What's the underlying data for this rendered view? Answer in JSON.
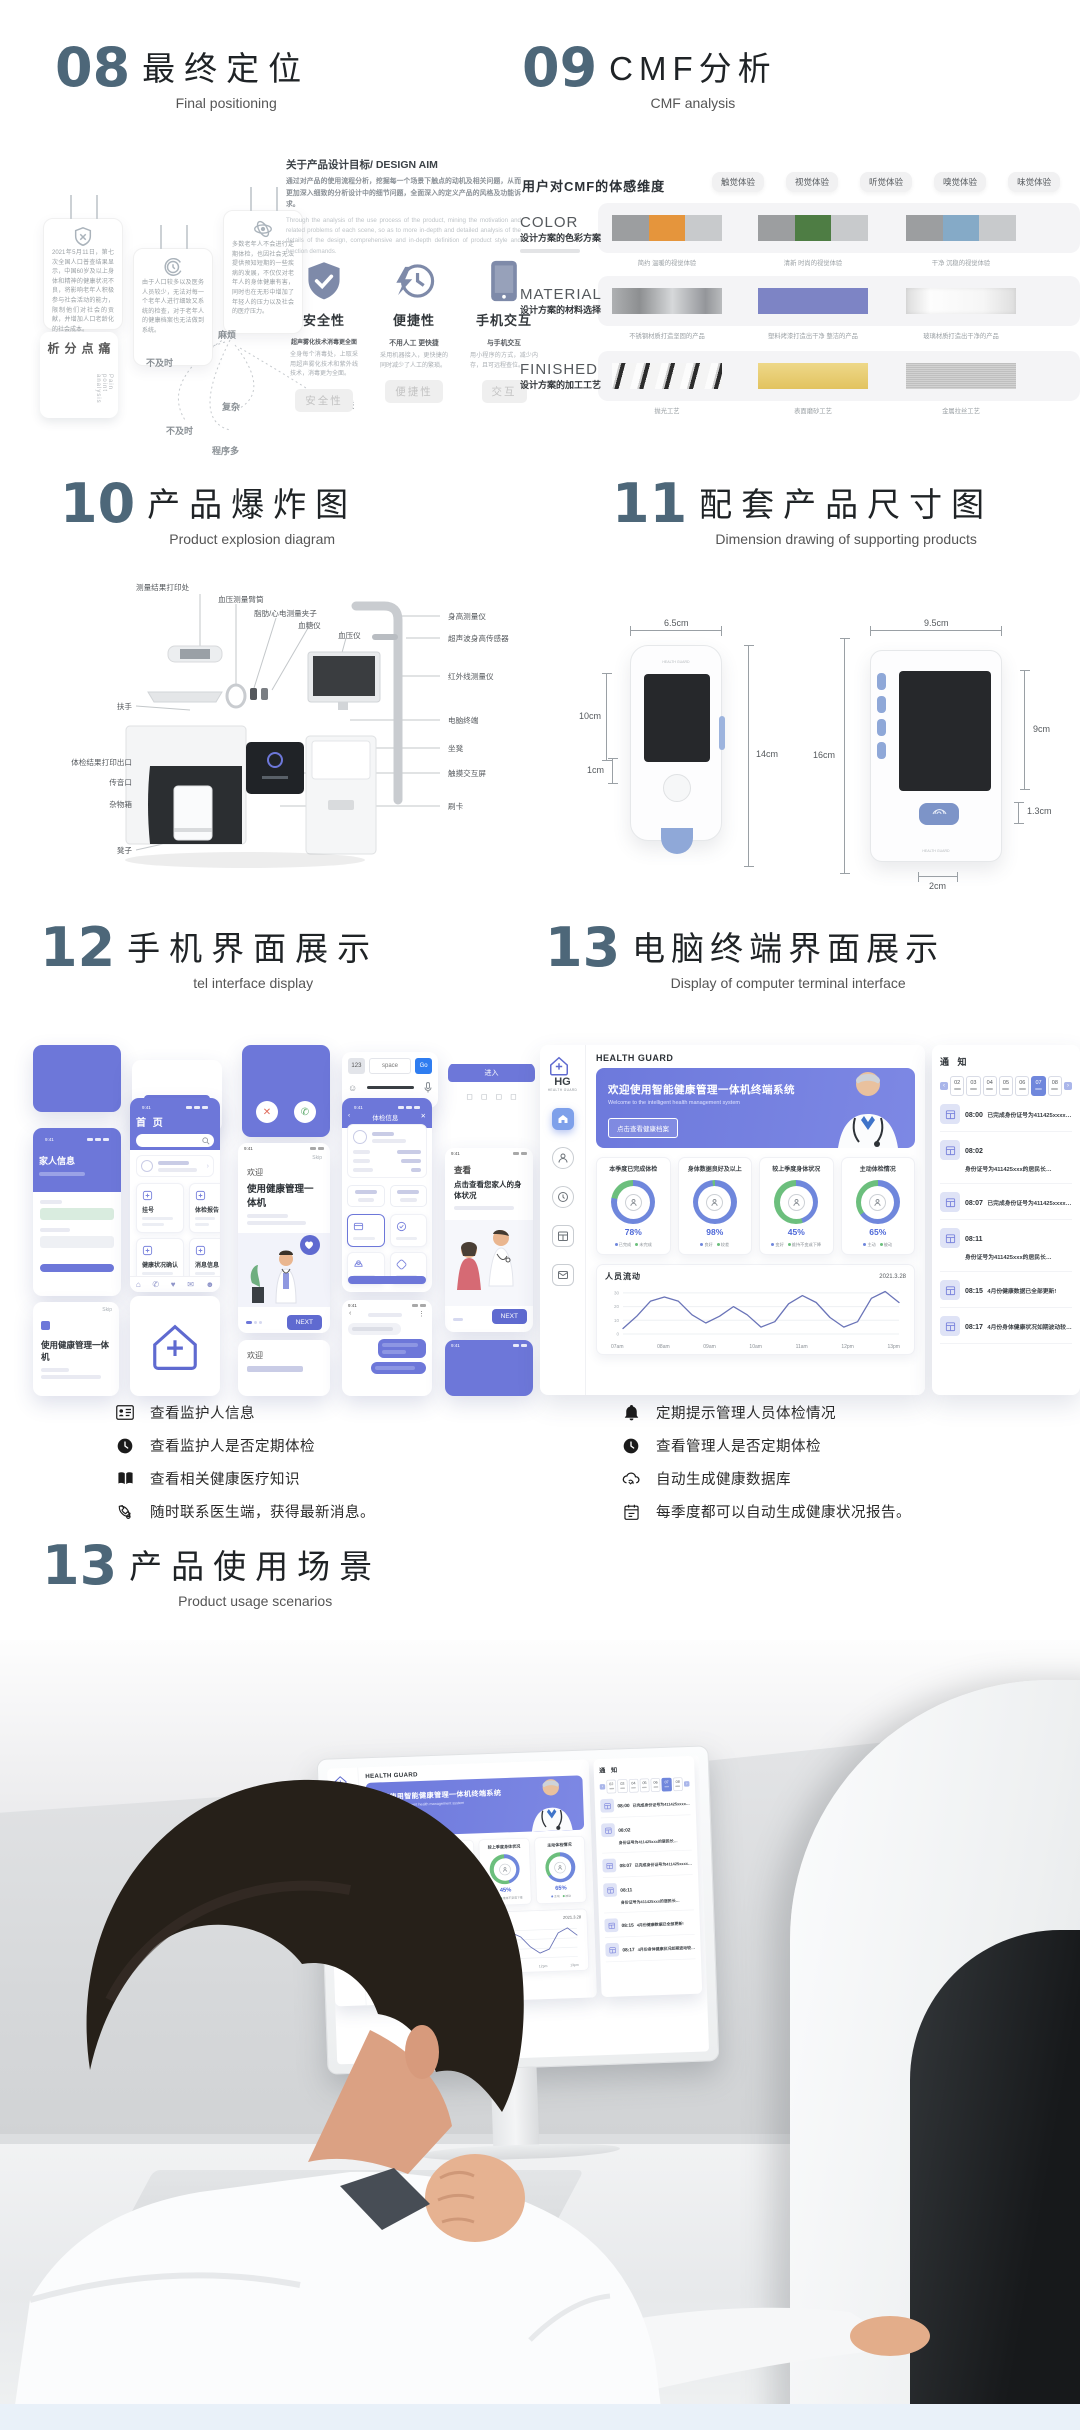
{
  "colors": {
    "accent_purple": "#6d77d9",
    "heading_slate": "#4d6779",
    "ring_blue": "#6f87dc",
    "ring_green": "#6cbf7d",
    "hero_purple": "#6d79dc"
  },
  "s08": {
    "num": "08",
    "title": "最终定位",
    "sub": "Final positioning",
    "cards": [
      {
        "text": "2021年5月11日，第七次全国人口普查结果显示，中国60岁及以上身体和精神的健康状况不良，将影响老年人积极参与社会活动的能力，限制他们对社会的贡献，并增加人口老龄化的社会成本。"
      },
      {
        "text": "由于人口较多以及医务人员较少，无法对每一个老年人进行细致又系统的检查，对于老年人的健康档案也无法做到系统。"
      },
      {
        "text": "多数老年人不会进行定期体检，也因社会无法提供预知短期的一些疾病的发展，不仅仅对老年人的身体健康有害，同时也在无形中增加了年轻人的压力以及社会的医疗压力。"
      }
    ],
    "pain": {
      "cn": "痛点分析",
      "en": "Pain point analysis"
    },
    "keywords": [
      "麻烦",
      "不及时",
      "复杂",
      "无法亲子互联",
      "不及时",
      "程序多"
    ],
    "aim_label": "关于产品设计目标/ DESIGN AIM",
    "aim_cn": "通过对产品的使用流程分析，挖掘每一个场景下触点的动机及相关问题，从而更加深入细致的分析设计中的细节问题，全面深入的定义产品的风格及功能诉求。",
    "aim_en": "Through the analysis of the use process of the product, mining the motivation and related problems of each scene, so as to more in-depth and detailed analysis of the details of the design, comprehensive and in-depth definition of product style and function demands.",
    "features": [
      {
        "title": "安全性",
        "strong": "超声雾化技术消毒更全面",
        "desc": "全身每个消毒处，上取采用超声雾化技术和紫外线技术，消毒更为全面。",
        "chip": "安全性"
      },
      {
        "title": "便捷性",
        "strong": "不用人工 更快捷",
        "desc": "采用机器接入，更快捷的同时减少了人工的繁琐。",
        "chip": "便捷性"
      },
      {
        "title": "手机交互",
        "strong": "与手机交互",
        "desc": "用小程序的方式，减少内存，且可远程查位。",
        "chip": "交互"
      }
    ]
  },
  "s09": {
    "num": "09",
    "title": "CMF分析",
    "sub": "CMF analysis",
    "dim_label": "用户对CMF的体感维度",
    "chips": [
      "触觉体验",
      "视觉体验",
      "听觉体验",
      "嗅觉体验",
      "味觉体验"
    ],
    "color_row": {
      "name": "COLOR",
      "sub": "设计方案的色彩方案",
      "items": [
        {
          "caption": "简约 温暖的视觉体验",
          "colors": [
            "#9c9ea0",
            "#e5953c",
            "#c8cacc"
          ]
        },
        {
          "caption": "清新 时尚的视觉体验",
          "colors": [
            "#9c9ea0",
            "#4e7d44",
            "#c8cacc"
          ]
        },
        {
          "caption": "干净 沉稳的视觉体验",
          "colors": [
            "#9c9ea0",
            "#85aac7",
            "#c8cacc"
          ]
        }
      ]
    },
    "material_row": {
      "name": "MATERIAL",
      "sub": "设计方案的材料选择",
      "items": [
        {
          "caption": "不锈钢材质打造坚固的产品",
          "texture": "steel"
        },
        {
          "caption": "塑料烤漆打造出干净 整洁的产品",
          "texture": "plastic"
        },
        {
          "caption": "玻璃材质打造出干净的产品",
          "texture": "glass"
        }
      ]
    },
    "finished_row": {
      "name": "FINISHED",
      "sub": "设计方案的加工工艺",
      "items": [
        {
          "caption": "抛光工艺",
          "texture": "polish"
        },
        {
          "caption": "表面磨砂工艺",
          "texture": "mattegold"
        },
        {
          "caption": "金属拉丝工艺",
          "texture": "brushed"
        }
      ]
    }
  },
  "s10": {
    "num": "10",
    "title": "产品爆炸图",
    "sub": "Product explosion diagram",
    "labels": {
      "print_spot": "测量结果打印处",
      "cuff": "血压测量臂筒",
      "clip": "脂肪/心电测量夹子",
      "glucose": "血糖仪",
      "bp": "血压仪",
      "armrest": "扶手",
      "result_outlet": "体检结果打印出口",
      "voice_port": "传音口",
      "storage": "杂物箱",
      "stool": "凳子",
      "height": "身高测量仪",
      "ultrasonic": "超声波身高传感器",
      "infrared": "红外线测量仪",
      "terminal": "电脑终端",
      "seat": "坐凳",
      "touch": "触摸交互屏",
      "card": "刷卡"
    }
  },
  "s11": {
    "num": "11",
    "title": "配套产品尺寸图",
    "sub": "Dimension drawing of supporting products",
    "dims": {
      "w1": "6.5cm",
      "h1s": "10cm",
      "h1": "14cm",
      "btn1": "1cm",
      "w2": "9.5cm",
      "h2": "16cm",
      "h2s": "9cm",
      "r13": "1.3cm",
      "r2": "2cm"
    }
  },
  "s12": {
    "num": "12",
    "title": "手机界面展示",
    "sub": "tel interface display",
    "time": "9:41",
    "home": {
      "title": "首 页",
      "menu": [
        {
          "t": "挂号"
        },
        {
          "t": "体检报告"
        },
        {
          "t": "健康状况确认"
        },
        {
          "t": "消息信息"
        },
        {
          "t": "健康档案"
        },
        {
          "t": "建议预警"
        }
      ]
    },
    "welcome": {
      "hello": "欢迎",
      "title": "使用健康管理一体机",
      "skip": "Skip",
      "next": "NEXT"
    },
    "view": {
      "hello": "查看",
      "title": "点击查看您家人的身体状况",
      "next": "NEXT"
    },
    "family": {
      "title": "家人信息"
    },
    "checkup": {
      "title": "体检信息"
    },
    "machine_card": "使用健康管理一体机",
    "welcome_small": "欢迎",
    "enter_btn": "进入",
    "keyboard": {
      "left": "123",
      "mid": "space",
      "go": "Go"
    }
  },
  "s13": {
    "num": "13",
    "title": "电脑终端界面展示",
    "sub": "Display of computer terminal interface",
    "terminal": {
      "brand": "HEALTH GUARD",
      "logo": {
        "hg": "HG",
        "sub": "HEALTH GUARD"
      },
      "hero": {
        "title": "欢迎使用智能健康管理一体机终端系统",
        "sub": "Welcome to the intelligent health management system",
        "btn": "点击查看健康档案"
      },
      "stats": [
        {
          "title": "本季度已完成体检",
          "pct": 78,
          "pct_label": "78%",
          "a": "已完成",
          "b": "未完成"
        },
        {
          "title": "身体数据良好及以上",
          "pct": 98,
          "pct_label": "98%",
          "a": "良好",
          "b": "较差"
        },
        {
          "title": "较上季度身体状况",
          "pct": 45,
          "pct_label": "45%",
          "a": "变好",
          "b": "维持不变或下降"
        },
        {
          "title": "主动体检情况",
          "pct": 65,
          "pct_label": "65%",
          "a": "主动",
          "b": "被动"
        }
      ],
      "flow": {
        "title": "人员流动",
        "date": "2021.3.28"
      },
      "notice": {
        "title": "通 知",
        "days": [
          {
            "d": "02"
          },
          {
            "d": "03"
          },
          {
            "d": "04"
          },
          {
            "d": "05"
          },
          {
            "d": "06"
          },
          {
            "d": "07",
            "cls": "sel"
          },
          {
            "d": "08"
          }
        ],
        "items": [
          {
            "time": "08:00",
            "text": "已完成身份证号为411425xxxx…"
          },
          {
            "time": "08:02",
            "text": "身份证号为411425xxx的居民长…"
          },
          {
            "time": "08:07",
            "text": "已完成身份证号为411425xxxx…"
          },
          {
            "time": "08:11",
            "text": "身份证号为411425xxx的居民长…"
          },
          {
            "time": "08:15",
            "text": "4月份健康数据已全部更新!"
          },
          {
            "time": "08:17",
            "text": "4月份身体健康状况如期波动较…"
          }
        ]
      }
    }
  },
  "legend": {
    "left": [
      {
        "icon": "id-card-icon",
        "text": "查看监护人信息"
      },
      {
        "icon": "clock-icon",
        "text": "查看监护人是否定期体检"
      },
      {
        "icon": "book-icon",
        "text": "查看相关健康医疗知识"
      },
      {
        "icon": "phone-call-icon",
        "text": "随时联系医生端，获得最新消息。"
      }
    ],
    "right": [
      {
        "icon": "bell-icon",
        "text": "定期提示管理人员体检情况"
      },
      {
        "icon": "clock-icon",
        "text": "查看管理人是否定期体检"
      },
      {
        "icon": "cloud-sync-icon",
        "text": "自动生成健康数据库"
      },
      {
        "icon": "calendar-icon",
        "text": "每季度都可以自动生成健康状况报告。"
      }
    ]
  },
  "s13b": {
    "num": "13",
    "title": "产品使用场景",
    "sub": "Product usage scenarios"
  },
  "chart_data": [
    {
      "type": "line",
      "title": "人员流动",
      "annotation_date": "2021.3.28",
      "x": [
        "07am",
        "08am",
        "09am",
        "10am",
        "11am",
        "12pm",
        "13pm"
      ],
      "values_at_ticks": [
        4,
        27,
        8,
        5,
        28,
        5,
        23
      ],
      "dense": [
        4,
        13,
        24,
        27,
        24,
        14,
        8,
        13,
        20,
        14,
        5,
        9,
        22,
        28,
        23,
        12,
        5,
        9,
        26,
        31,
        23
      ],
      "ylim": [
        0,
        35
      ],
      "yticks": [
        0,
        10,
        20,
        30
      ],
      "grid": true,
      "legend_position": "none",
      "ylabel": "",
      "xlabel": ""
    },
    {
      "type": "donut-set",
      "title": "体检数据占比",
      "items": [
        {
          "label": "本季度已完成体检",
          "value": 78
        },
        {
          "label": "身体数据良好及以上",
          "value": 98
        },
        {
          "label": "较上季度身体状况",
          "value": 45
        },
        {
          "label": "主动体检情况",
          "value": 65
        }
      ]
    }
  ]
}
